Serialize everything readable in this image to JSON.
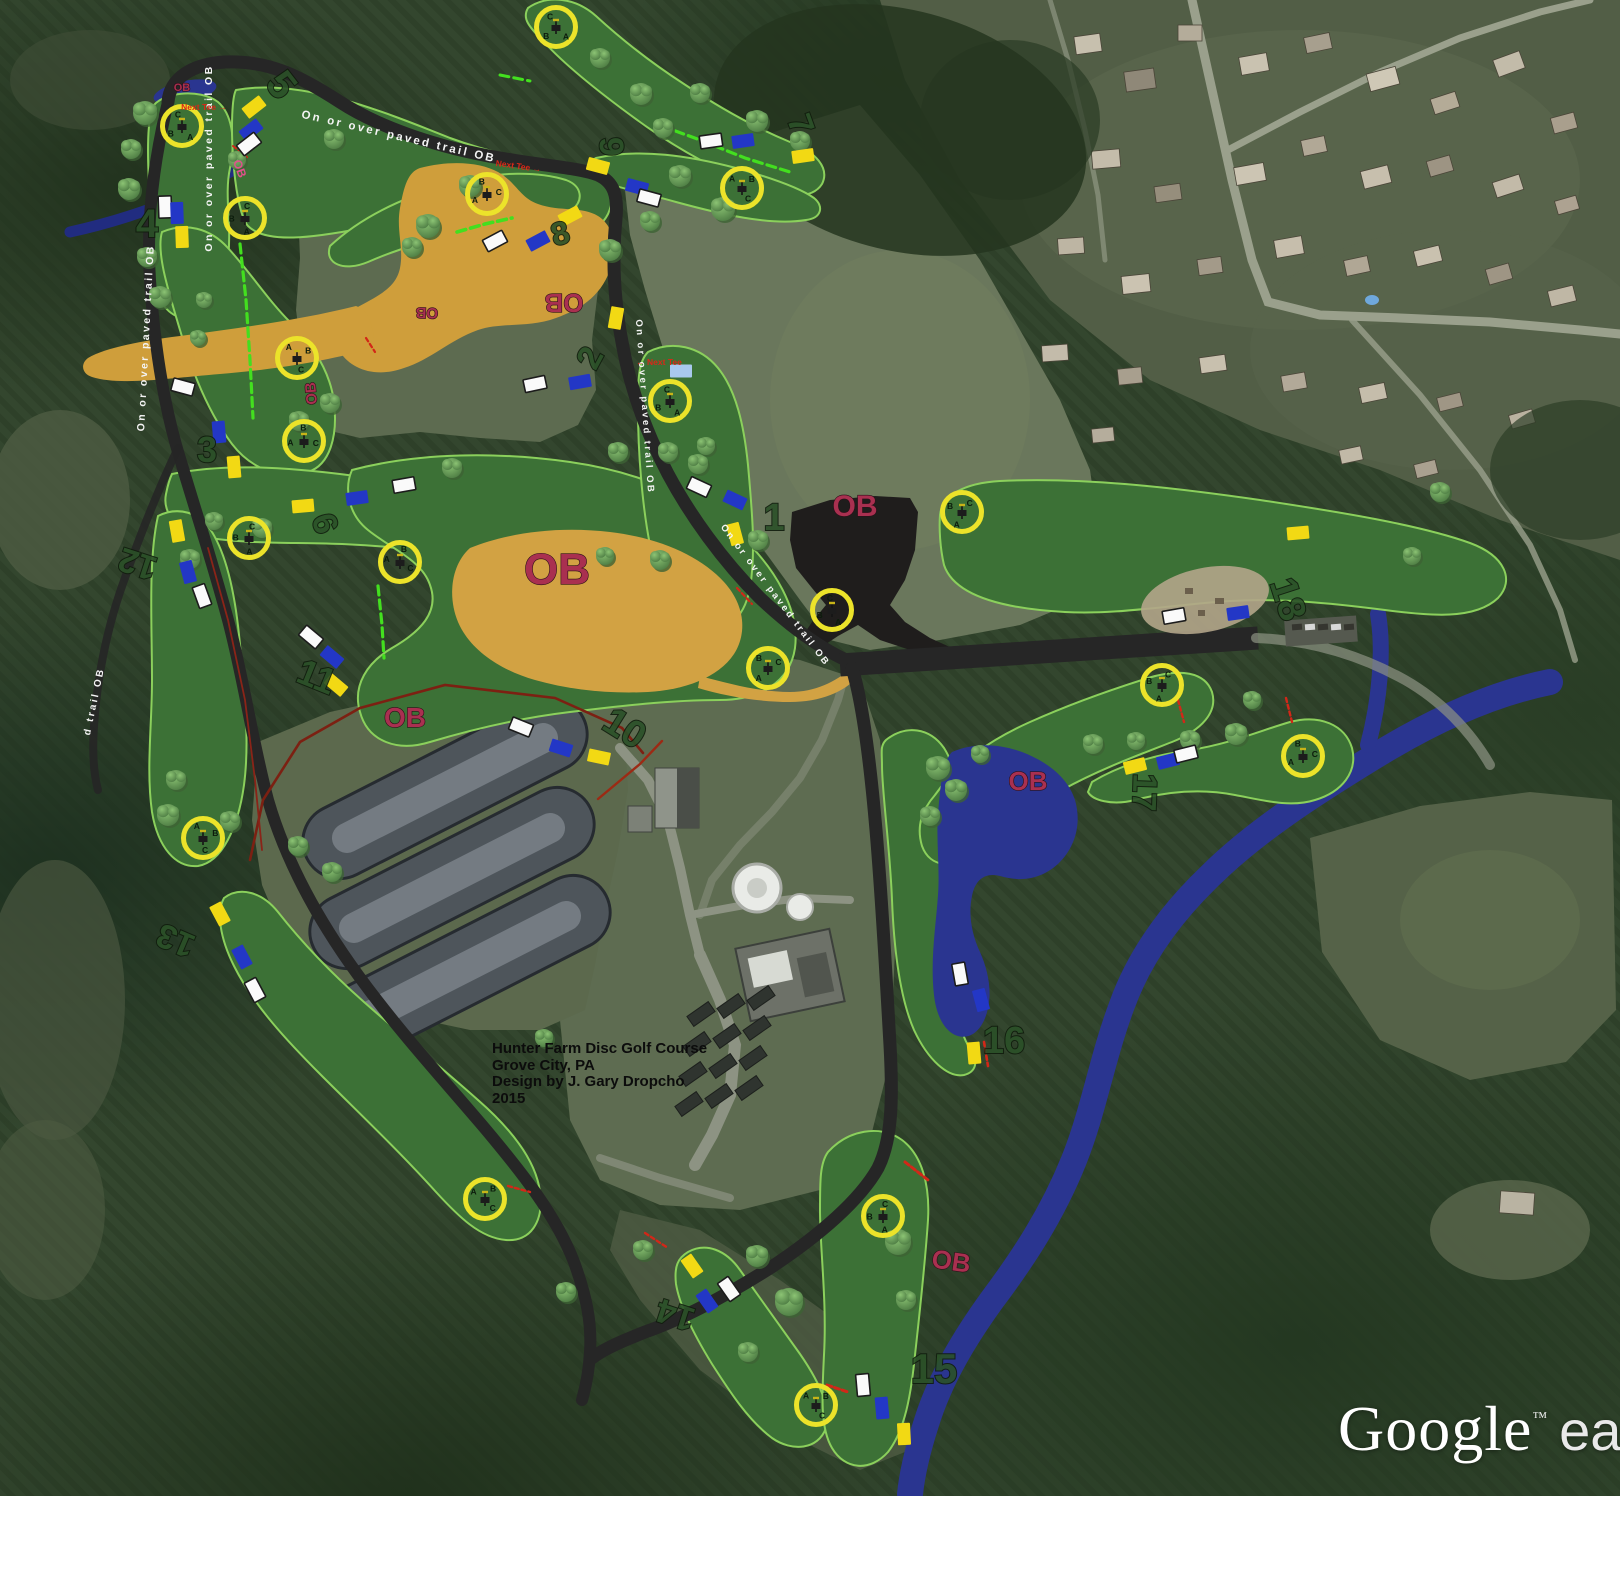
{
  "title_block": {
    "line1": "Hunter Farm Disc Golf Course",
    "line2": "Grove City, PA",
    "line3": "Design by J. Gary Dropcho",
    "line4": "2015"
  },
  "watermark": {
    "primary": "Google",
    "tm": "™",
    "secondary": "ea"
  },
  "labels": {
    "trail": "On or over paved trail OB",
    "trail_partial": "d trail OB",
    "ob": "OB",
    "next_tee_right": "Next Tee →",
    "next_tee_left": "← Next Tee"
  },
  "colors": {
    "fairway": "#3c7136",
    "fairway_edge": "#8bd05c",
    "ob_tan": "#cf9e3b",
    "ob_black": "#1f1d1c",
    "water": "#2a3590",
    "creek_dark": "#212c80",
    "trail": "#262626",
    "basket_ring": "#ece32a",
    "tee_yellow": "#f2d914",
    "tee_blue": "#2337c6",
    "tee_white": "#fafafa",
    "tee_lightblue": "#a9c9ee",
    "ob_text": "#a93050",
    "bright_green": "#43df1f",
    "red_dash": "#d22718",
    "red_boundary": "#7c2012"
  },
  "holes": [
    [
      "1",
      774,
      530,
      0,
      38
    ],
    [
      "2",
      600,
      363,
      -62,
      34
    ],
    [
      "3",
      207,
      462,
      0,
      36
    ],
    [
      "4",
      147,
      237,
      0,
      40
    ],
    [
      "5",
      271,
      93,
      52,
      40
    ],
    [
      "6",
      314,
      527,
      72,
      34
    ],
    [
      "7",
      790,
      128,
      70,
      34
    ],
    [
      "8",
      563,
      244,
      -15,
      32
    ],
    [
      "9",
      600,
      147,
      88,
      34
    ],
    [
      "10",
      618,
      739,
      32,
      38
    ],
    [
      "11",
      312,
      688,
      22,
      36
    ],
    [
      "12",
      141,
      553,
      198,
      34
    ],
    [
      "13",
      180,
      930,
      203,
      34
    ],
    [
      "14",
      679,
      1304,
      198,
      34
    ],
    [
      "15",
      934,
      1383,
      0,
      42
    ],
    [
      "16",
      1004,
      1053,
      0,
      38
    ],
    [
      "17",
      1133,
      792,
      92,
      34
    ],
    [
      "18",
      1276,
      603,
      72,
      38
    ]
  ],
  "baskets": [
    [
      182,
      126,
      -20
    ],
    [
      245,
      218,
      10
    ],
    [
      487,
      194,
      80
    ],
    [
      297,
      358,
      160
    ],
    [
      304,
      441,
      100
    ],
    [
      249,
      538,
      15
    ],
    [
      400,
      562,
      120
    ],
    [
      203,
      838,
      170
    ],
    [
      556,
      27,
      -30
    ],
    [
      742,
      188,
      150
    ],
    [
      670,
      401,
      -15
    ],
    [
      962,
      512,
      40
    ],
    [
      832,
      610,
      -10
    ],
    [
      768,
      668,
      60
    ],
    [
      1162,
      685,
      30
    ],
    [
      1303,
      756,
      80
    ],
    [
      485,
      1199,
      140
    ],
    [
      883,
      1216,
      10
    ],
    [
      816,
      1405,
      150
    ]
  ],
  "tees": [
    [
      254,
      107,
      "y",
      -38
    ],
    [
      251,
      130,
      "b",
      -38
    ],
    [
      249,
      144,
      "w",
      -38
    ],
    [
      165,
      207,
      "w",
      88
    ],
    [
      177,
      213,
      "b",
      88
    ],
    [
      182,
      237,
      "y",
      88
    ],
    [
      570,
      216,
      "y",
      -28
    ],
    [
      538,
      241,
      "b",
      -28
    ],
    [
      495,
      241,
      "w",
      -28
    ],
    [
      616,
      318,
      "y",
      -80
    ],
    [
      681,
      371,
      "l",
      0
    ],
    [
      535,
      384,
      "w",
      -12
    ],
    [
      580,
      382,
      "b",
      -10
    ],
    [
      699,
      487,
      "w",
      25
    ],
    [
      735,
      500,
      "b",
      25
    ],
    [
      735,
      534,
      "y",
      75
    ],
    [
      219,
      432,
      "b",
      85
    ],
    [
      234,
      467,
      "y",
      85
    ],
    [
      183,
      387,
      "w",
      15
    ],
    [
      303,
      506,
      "y",
      -5
    ],
    [
      357,
      498,
      "b",
      -8
    ],
    [
      404,
      485,
      "w",
      -10
    ],
    [
      177,
      531,
      "y",
      80
    ],
    [
      188,
      572,
      "b",
      75
    ],
    [
      202,
      596,
      "w",
      70
    ],
    [
      311,
      637,
      "w",
      40
    ],
    [
      332,
      657,
      "b",
      40
    ],
    [
      336,
      685,
      "y",
      40
    ],
    [
      598,
      166,
      "y",
      15
    ],
    [
      637,
      187,
      "b",
      15
    ],
    [
      649,
      198,
      "w",
      15
    ],
    [
      711,
      141,
      "w",
      -8
    ],
    [
      743,
      141,
      "b",
      -8
    ],
    [
      803,
      156,
      "y",
      -8
    ],
    [
      1174,
      616,
      "w",
      -10
    ],
    [
      1238,
      613,
      "b",
      -8
    ],
    [
      1298,
      533,
      "y",
      -5
    ],
    [
      1135,
      766,
      "y",
      -14
    ],
    [
      1168,
      761,
      "b",
      -14
    ],
    [
      1186,
      754,
      "w",
      -14
    ],
    [
      960,
      974,
      "w",
      80
    ],
    [
      981,
      1000,
      "b",
      75
    ],
    [
      974,
      1053,
      "y",
      85
    ],
    [
      863,
      1385,
      "w",
      85
    ],
    [
      882,
      1408,
      "b",
      85
    ],
    [
      904,
      1434,
      "y",
      87
    ],
    [
      692,
      1266,
      "y",
      55
    ],
    [
      707,
      1301,
      "b",
      55
    ],
    [
      729,
      1289,
      "w",
      55
    ],
    [
      220,
      914,
      "y",
      62
    ],
    [
      242,
      957,
      "b",
      62
    ],
    [
      255,
      990,
      "w",
      62
    ],
    [
      521,
      727,
      "w",
      22
    ],
    [
      561,
      748,
      "b",
      18
    ],
    [
      599,
      757,
      "y",
      12
    ]
  ],
  "ob_labels": [
    [
      557,
      584,
      44,
      0,
      0
    ],
    [
      855,
      516,
      30,
      0,
      0
    ],
    [
      405,
      727,
      28,
      0,
      0
    ],
    [
      1028,
      790,
      26,
      0,
      0
    ],
    [
      950,
      1270,
      26,
      8,
      0
    ],
    [
      564,
      294,
      26,
      180,
      0
    ],
    [
      427,
      308,
      15,
      182,
      0
    ],
    [
      316,
      393,
      15,
      -95,
      0
    ],
    [
      182,
      91,
      11,
      0,
      0
    ],
    [
      236,
      170,
      12,
      70,
      1
    ]
  ],
  "trail_labels": [
    {
      "x": 398,
      "y": 140,
      "r": 13,
      "fs": 11.5
    },
    {
      "x": 212,
      "y": 158,
      "r": -90,
      "fs": 10.5
    },
    {
      "x": 149,
      "y": 338,
      "r": -87,
      "fs": 10.5
    },
    {
      "x": 97,
      "y": 702,
      "r": -78,
      "fs": 10,
      "t": "d trail OB"
    },
    {
      "x": 642,
      "y": 407,
      "r": 86,
      "fs": 9.5
    },
    {
      "x": 773,
      "y": 597,
      "r": 53,
      "fs": 9.5
    }
  ],
  "next_tee": [
    [
      204,
      110,
      0,
      "r"
    ],
    [
      518,
      169,
      8,
      "r"
    ],
    [
      659,
      365,
      0,
      "l"
    ]
  ],
  "green_lines": [
    {
      "p": [
        [
          240,
          244
        ],
        [
          246,
          300
        ],
        [
          250,
          360
        ],
        [
          253,
          418
        ]
      ],
      "w": 3.2
    },
    {
      "p": [
        [
          457,
          232
        ],
        [
          485,
          224
        ],
        [
          512,
          218
        ]
      ],
      "w": 3.6
    },
    {
      "p": [
        [
          500,
          75
        ],
        [
          530,
          81
        ]
      ],
      "w": 3
    },
    {
      "p": [
        [
          662,
          126
        ],
        [
          700,
          140
        ],
        [
          745,
          158
        ],
        [
          790,
          172
        ]
      ],
      "w": 3.2
    },
    {
      "p": [
        [
          378,
          586
        ],
        [
          382,
          625
        ],
        [
          384,
          658
        ]
      ],
      "w": 3.2
    }
  ],
  "red_lines": [
    {
      "p": [
        [
          250,
          860
        ],
        [
          263,
          800
        ],
        [
          300,
          742
        ],
        [
          360,
          708
        ],
        [
          445,
          685
        ],
        [
          555,
          698
        ],
        [
          622,
          728
        ],
        [
          643,
          753
        ]
      ],
      "w": 2.6,
      "c": "#7c2012"
    },
    {
      "p": [
        [
          598,
          799
        ],
        [
          640,
          764
        ],
        [
          662,
          741
        ]
      ],
      "w": 2.4,
      "c": "#9c2a14"
    },
    {
      "p": [
        [
          208,
          548
        ],
        [
          228,
          620
        ],
        [
          245,
          700
        ],
        [
          255,
          780
        ],
        [
          262,
          850
        ]
      ],
      "w": 1.8,
      "c": "#8a2418"
    },
    {
      "p": [
        [
          1178,
          700
        ],
        [
          1184,
          722
        ]
      ],
      "w": 2.4,
      "c": "#d22718",
      "d": "4 3"
    },
    {
      "p": [
        [
          1286,
          698
        ],
        [
          1292,
          722
        ]
      ],
      "w": 2.4,
      "c": "#d22718",
      "d": "4 3"
    },
    {
      "p": [
        [
          905,
          1162
        ],
        [
          928,
          1180
        ]
      ],
      "w": 3,
      "c": "#d22718",
      "d": "5 3"
    },
    {
      "p": [
        [
          827,
          1385
        ],
        [
          848,
          1392
        ]
      ],
      "w": 3,
      "c": "#d22718",
      "d": "5 3"
    },
    {
      "p": [
        [
          508,
          1186
        ],
        [
          530,
          1192
        ]
      ],
      "w": 2.4,
      "c": "#d22718",
      "d": "4 3"
    },
    {
      "p": [
        [
          645,
          1233
        ],
        [
          668,
          1248
        ]
      ],
      "w": 2.4,
      "c": "#d22718",
      "d": "4 3"
    },
    {
      "p": [
        [
          366,
          338
        ],
        [
          375,
          352
        ]
      ],
      "w": 2.2,
      "c": "#d22718",
      "d": "4 3"
    },
    {
      "p": [
        [
          984,
          1042
        ],
        [
          988,
          1066
        ]
      ],
      "w": 2.6,
      "c": "#d22718",
      "d": "4 3"
    },
    {
      "p": [
        [
          737,
          588
        ],
        [
          752,
          604
        ]
      ],
      "w": 2.2,
      "c": "#d22718",
      "d": "4 3"
    },
    {
      "p": [
        [
          233,
          146
        ],
        [
          248,
          158
        ]
      ],
      "w": 2,
      "c": "#d22718",
      "d": "4 3"
    }
  ],
  "decor": {
    "trees": [
      [
        145,
        113,
        12
      ],
      [
        131,
        149,
        10
      ],
      [
        129,
        189,
        11
      ],
      [
        147,
        257,
        10
      ],
      [
        160,
        297,
        11
      ],
      [
        237,
        160,
        9
      ],
      [
        334,
        139,
        10
      ],
      [
        470,
        186,
        11
      ],
      [
        600,
        58,
        10
      ],
      [
        641,
        94,
        11
      ],
      [
        663,
        128,
        10
      ],
      [
        700,
        93,
        10
      ],
      [
        757,
        121,
        11
      ],
      [
        800,
        141,
        10
      ],
      [
        680,
        176,
        11
      ],
      [
        723,
        209,
        12
      ],
      [
        650,
        221,
        10
      ],
      [
        610,
        250,
        11
      ],
      [
        428,
        226,
        12
      ],
      [
        412,
        247,
        10
      ],
      [
        204,
        300,
        8
      ],
      [
        198,
        338,
        8
      ],
      [
        330,
        403,
        10
      ],
      [
        299,
        421,
        10
      ],
      [
        262,
        528,
        10
      ],
      [
        214,
        521,
        9
      ],
      [
        190,
        559,
        10
      ],
      [
        176,
        780,
        10
      ],
      [
        168,
        815,
        11
      ],
      [
        230,
        821,
        10
      ],
      [
        298,
        846,
        10
      ],
      [
        332,
        872,
        10
      ],
      [
        452,
        468,
        10
      ],
      [
        605,
        556,
        9
      ],
      [
        660,
        560,
        10
      ],
      [
        698,
        464,
        10
      ],
      [
        758,
        540,
        10
      ],
      [
        618,
        452,
        10
      ],
      [
        668,
        452,
        10
      ],
      [
        706,
        446,
        9
      ],
      [
        643,
        1250,
        10
      ],
      [
        757,
        1256,
        11
      ],
      [
        789,
        1302,
        14
      ],
      [
        898,
        1242,
        13
      ],
      [
        906,
        1300,
        10
      ],
      [
        938,
        768,
        12
      ],
      [
        956,
        790,
        11
      ],
      [
        930,
        816,
        10
      ],
      [
        980,
        754,
        9
      ],
      [
        1093,
        744,
        10
      ],
      [
        1136,
        741,
        9
      ],
      [
        1190,
        740,
        10
      ],
      [
        1236,
        734,
        11
      ],
      [
        1252,
        700,
        9
      ],
      [
        1440,
        492,
        10
      ],
      [
        1412,
        556,
        9
      ],
      [
        566,
        1292,
        10
      ],
      [
        748,
        1352,
        10
      ],
      [
        544,
        1038,
        9
      ]
    ],
    "houses": [
      [
        1075,
        35,
        26,
        18,
        -8,
        "#c7c0ae"
      ],
      [
        1125,
        70,
        30,
        20,
        -8,
        "#8f8878"
      ],
      [
        1178,
        25,
        24,
        16,
        0,
        "#b4ac9a"
      ],
      [
        1240,
        55,
        28,
        18,
        -10,
        "#c9c2b0"
      ],
      [
        1305,
        35,
        26,
        16,
        -12,
        "#a79f8e"
      ],
      [
        1368,
        70,
        30,
        18,
        -15,
        "#cfc8b6"
      ],
      [
        1432,
        95,
        26,
        16,
        -18,
        "#b4ab97"
      ],
      [
        1495,
        55,
        28,
        18,
        -20,
        "#c2bba9"
      ],
      [
        1552,
        115,
        24,
        16,
        -15,
        "#a99f8d"
      ],
      [
        1092,
        150,
        28,
        18,
        -5,
        "#c4bcaa"
      ],
      [
        1155,
        185,
        26,
        16,
        -8,
        "#968e7c"
      ],
      [
        1235,
        165,
        30,
        18,
        -10,
        "#ccc5b3"
      ],
      [
        1302,
        138,
        24,
        16,
        -12,
        "#b1a896"
      ],
      [
        1362,
        168,
        28,
        18,
        -14,
        "#c7bfad"
      ],
      [
        1428,
        158,
        24,
        16,
        -16,
        "#9d9483"
      ],
      [
        1494,
        178,
        28,
        16,
        -18,
        "#c2baa8"
      ],
      [
        1556,
        198,
        22,
        14,
        -16,
        "#ada291"
      ],
      [
        1058,
        238,
        26,
        16,
        -4,
        "#bdb5a3"
      ],
      [
        1122,
        275,
        28,
        18,
        -6,
        "#cbc3b1"
      ],
      [
        1198,
        258,
        24,
        16,
        -8,
        "#a39a89"
      ],
      [
        1275,
        238,
        28,
        18,
        -10,
        "#c6beac"
      ],
      [
        1345,
        258,
        24,
        16,
        -12,
        "#b0a795"
      ],
      [
        1415,
        248,
        26,
        16,
        -14,
        "#c9c1af"
      ],
      [
        1487,
        266,
        24,
        16,
        -16,
        "#9e9584"
      ],
      [
        1549,
        288,
        26,
        16,
        -14,
        "#bfb7a5"
      ],
      [
        968,
        298,
        24,
        16,
        20,
        "#b7afa0"
      ],
      [
        1042,
        345,
        26,
        16,
        -4,
        "#c3bbaa"
      ],
      [
        1118,
        368,
        24,
        16,
        -6,
        "#a89f8e"
      ],
      [
        1200,
        356,
        26,
        16,
        -8,
        "#c8c0ae"
      ],
      [
        1282,
        374,
        24,
        16,
        -10,
        "#b2a998"
      ],
      [
        1360,
        385,
        26,
        16,
        -12,
        "#c5bdab"
      ],
      [
        1438,
        395,
        24,
        14,
        -14,
        "#9f9685"
      ],
      [
        1510,
        412,
        24,
        14,
        -16,
        "#bab2a0"
      ],
      [
        1340,
        448,
        22,
        14,
        -12,
        "#c1b9a7"
      ],
      [
        1415,
        462,
        22,
        14,
        -14,
        "#aaa190"
      ],
      [
        1092,
        428,
        22,
        14,
        -6,
        "#b5ad9c"
      ],
      [
        1500,
        1192,
        34,
        22,
        4,
        "#b9b3a2"
      ],
      [
        672,
        1166,
        36,
        12,
        8,
        "#b9b3a2"
      ]
    ]
  }
}
